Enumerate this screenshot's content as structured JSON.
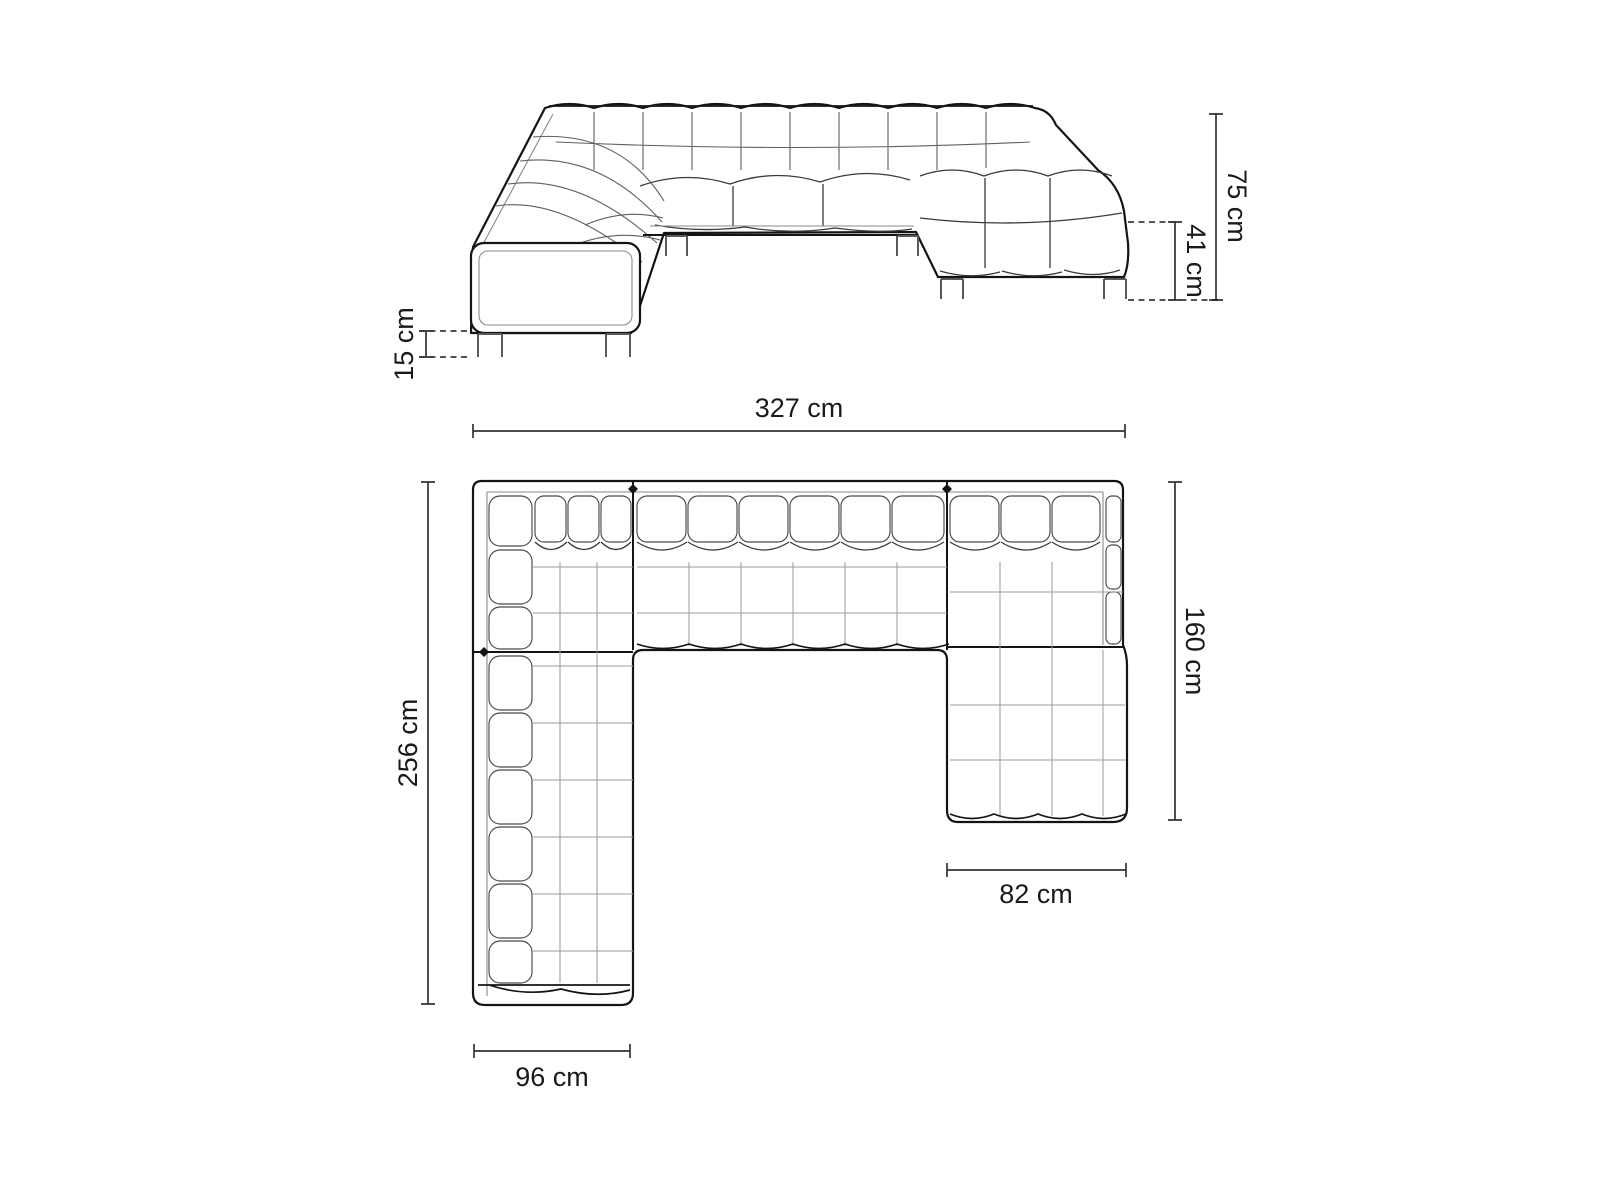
{
  "diagram": {
    "colors": {
      "background": "#ffffff",
      "outline": "#141414",
      "tufting": "#5f5f5f",
      "grid": "#9a9a9a",
      "dimension_line": "#333333",
      "dimension_text": "#1a1a1a"
    },
    "dimensions": {
      "overall_height": {
        "label": "75 cm",
        "value": 75,
        "unit": "cm",
        "orientation": "vertical",
        "view": "front"
      },
      "seat_height": {
        "label": "41 cm",
        "value": 41,
        "unit": "cm",
        "orientation": "vertical",
        "view": "front"
      },
      "leg_height": {
        "label": "15 cm",
        "value": 15,
        "unit": "cm",
        "orientation": "vertical",
        "view": "front"
      },
      "overall_width": {
        "label": "327 cm",
        "value": 327,
        "unit": "cm",
        "orientation": "horizontal",
        "view": "plan"
      },
      "overall_depth": {
        "label": "256 cm",
        "value": 256,
        "unit": "cm",
        "orientation": "vertical",
        "view": "plan"
      },
      "chaise_depth": {
        "label": "160 cm",
        "value": 160,
        "unit": "cm",
        "orientation": "vertical",
        "view": "plan"
      },
      "left_arm_width": {
        "label": "96 cm",
        "value": 96,
        "unit": "cm",
        "orientation": "horizontal",
        "view": "plan"
      },
      "chaise_width": {
        "label": "82 cm",
        "value": 82,
        "unit": "cm",
        "orientation": "horizontal",
        "view": "plan"
      }
    }
  }
}
